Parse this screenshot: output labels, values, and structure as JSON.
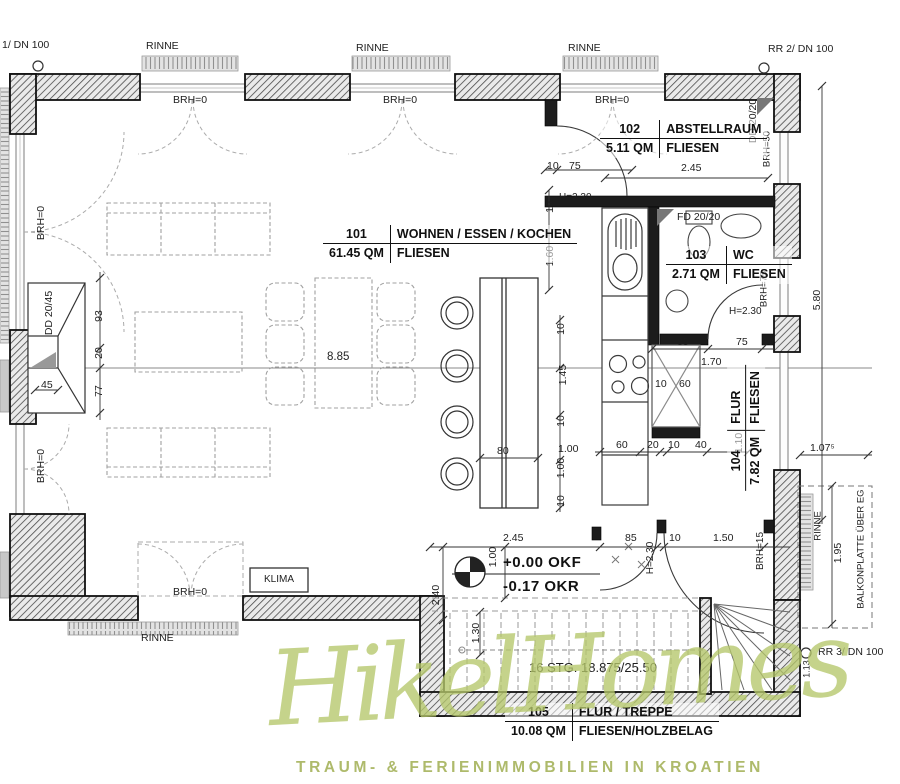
{
  "meta": {
    "paper_color": "#ffffff",
    "line_color": "#2b2b2b",
    "dash_color": "#9a9a9a",
    "watermark_color": "#b5c66a"
  },
  "rooms": {
    "living": {
      "number": "101",
      "name": "WOHNEN / ESSEN / KOCHEN",
      "area": "61.45 QM",
      "floor": "FLIESEN"
    },
    "storage": {
      "number": "102",
      "name": "ABSTELLRAUM",
      "area": "5.11 QM",
      "floor": "FLIESEN"
    },
    "wc": {
      "number": "103",
      "name": "WC",
      "area": "2.71 QM",
      "floor": "FLIESEN"
    },
    "hall": {
      "number": "104",
      "name": "FLUR",
      "area": "7.82 QM",
      "floor": "FLIESEN"
    },
    "stair_hall": {
      "number": "105",
      "name": "FLUR / TREPPE",
      "area": "10.08 QM",
      "floor": "FLIESEN/HOLZBELAG"
    }
  },
  "levels": {
    "floor_finished": "+0.00 OKF",
    "floor_raw": "-0.17 OKR"
  },
  "stairs": {
    "note": "16 STG. 18.875/25.50"
  },
  "drains": {
    "left": "1/ DN 100",
    "right": "RR 2/ DN 100",
    "bottom": "RR 3/ DN 100"
  },
  "annotations": {
    "rinne": "RINNE",
    "klima": "KLIMA",
    "balkonplatte": "BALKONPLATTE ÜBER EG",
    "brh0": "BRH=0",
    "brh15": "BRH=15",
    "brh50": "BRH=50",
    "brh75": "BRH=75",
    "h230": "H=2.30",
    "dd2045": "DD 20/45",
    "dd2020": "DD 20/20",
    "fd2020": "FD 20/20"
  },
  "dims": {
    "d885": "8.85",
    "d245": "2.45",
    "d580": "5.80",
    "d1075": "1.07⁵",
    "d195": "1.95",
    "d113": "1.13",
    "d10": "10",
    "d20": "20",
    "d40": "40",
    "d45": "45",
    "d60": "60",
    "d75": "75",
    "d77": "77",
    "d80": "80",
    "d85": "85",
    "d93": "93",
    "d100": "1.00",
    "d110": "1.10",
    "d130": "1.30",
    "d145": "1.45",
    "d150": "1.50",
    "d160": "1.60",
    "d170": "1.70",
    "d240": "2.40"
  },
  "watermark": {
    "name": "HikelHomes",
    "tagline": "TRAUM- & FERIENIMMOBILIEN IN KROATIEN"
  }
}
